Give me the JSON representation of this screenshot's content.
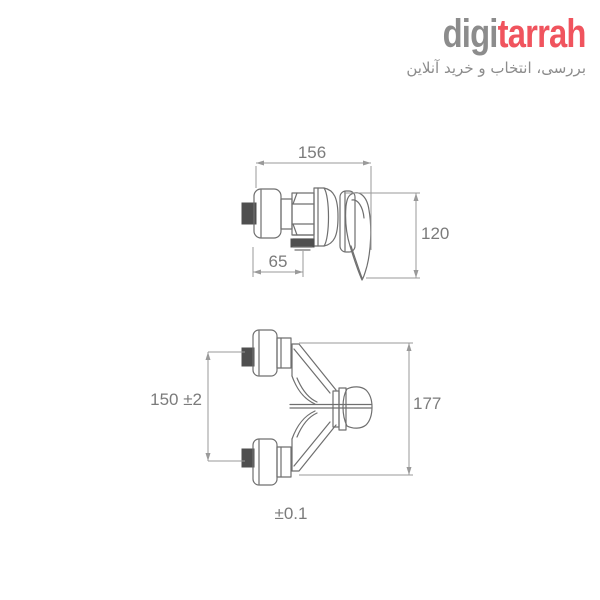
{
  "logo": {
    "brand_gray": "digi",
    "brand_red": "tarrah",
    "tagline": "بررسی، انتخاب و خرید آنلاین"
  },
  "colors": {
    "logo_gray": "#8c8c8c",
    "logo_red": "#f0545e",
    "drawing_line": "#6f6f6f",
    "dimension_line": "#9a9a9a",
    "dimension_text": "#7b7b7b",
    "dark_fitting": "#4f4f4f",
    "background": "#ffffff"
  },
  "diagram": {
    "side_view": {
      "dim_width": "156",
      "dim_height": "120",
      "dim_outlet": "65"
    },
    "top_view": {
      "dim_centers": "150 ±2",
      "dim_depth": "177",
      "dim_tolerance": "±0.1"
    }
  }
}
